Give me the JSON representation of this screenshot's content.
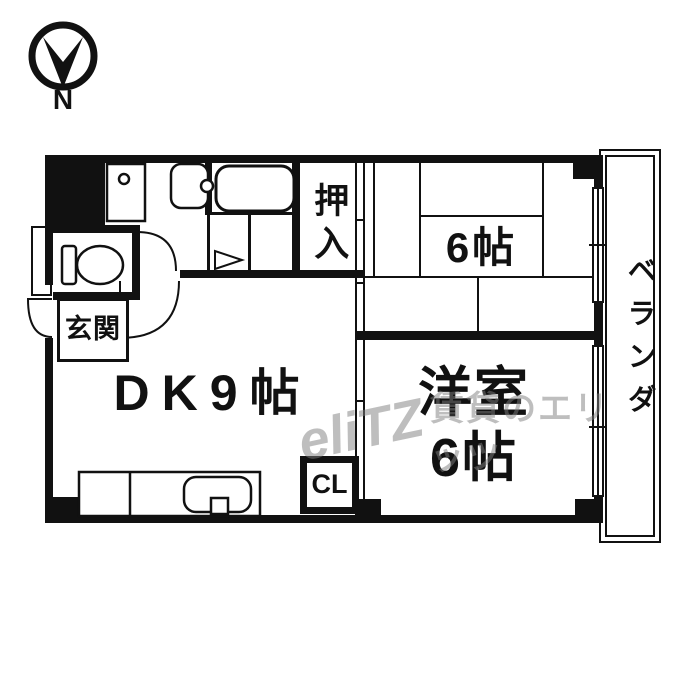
{
  "compass": {
    "label": "N"
  },
  "plan": {
    "entrance": "玄関",
    "dk": "DK9帖",
    "tatami_room": "6帖",
    "western_room_line1": "洋室",
    "western_room_line2": "6帖",
    "oshiire": "押入",
    "cl": "CL",
    "veranda": "ベランダ"
  },
  "watermark": {
    "logo": "eliTZ",
    "text": "賃貸のエリッツ"
  },
  "colors": {
    "line": "#111111",
    "watermark_gray": "rgba(125,125,125,0.5)"
  }
}
